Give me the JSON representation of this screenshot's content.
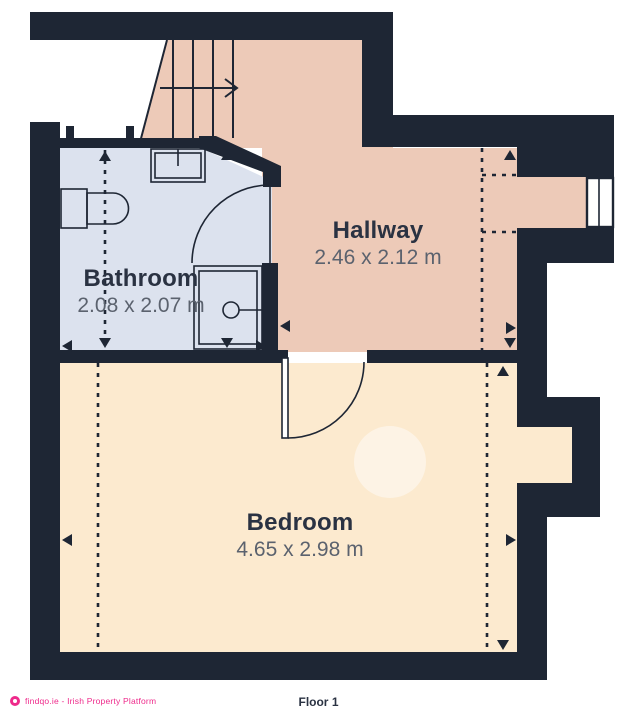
{
  "colors": {
    "wall": "#1e2634",
    "hallway": "#edcab8",
    "bathroom": "#dce2ee",
    "bedroom": "#fceacf",
    "label": "#2a3242",
    "dim": "#5b626e",
    "pink": "#ee2a8b",
    "bg": "#ffffff"
  },
  "rooms": {
    "bathroom": {
      "name": "Bathroom",
      "dimensions": "2.08 x 2.07 m"
    },
    "hallway": {
      "name": "Hallway",
      "dimensions": "2.46 x 2.12 m"
    },
    "bedroom": {
      "name": "Bedroom",
      "dimensions": "4.65 x 2.98 m"
    }
  },
  "footer": {
    "brand": "findqo.ie - Irish Property Platform",
    "floor_label": "Floor 1"
  }
}
